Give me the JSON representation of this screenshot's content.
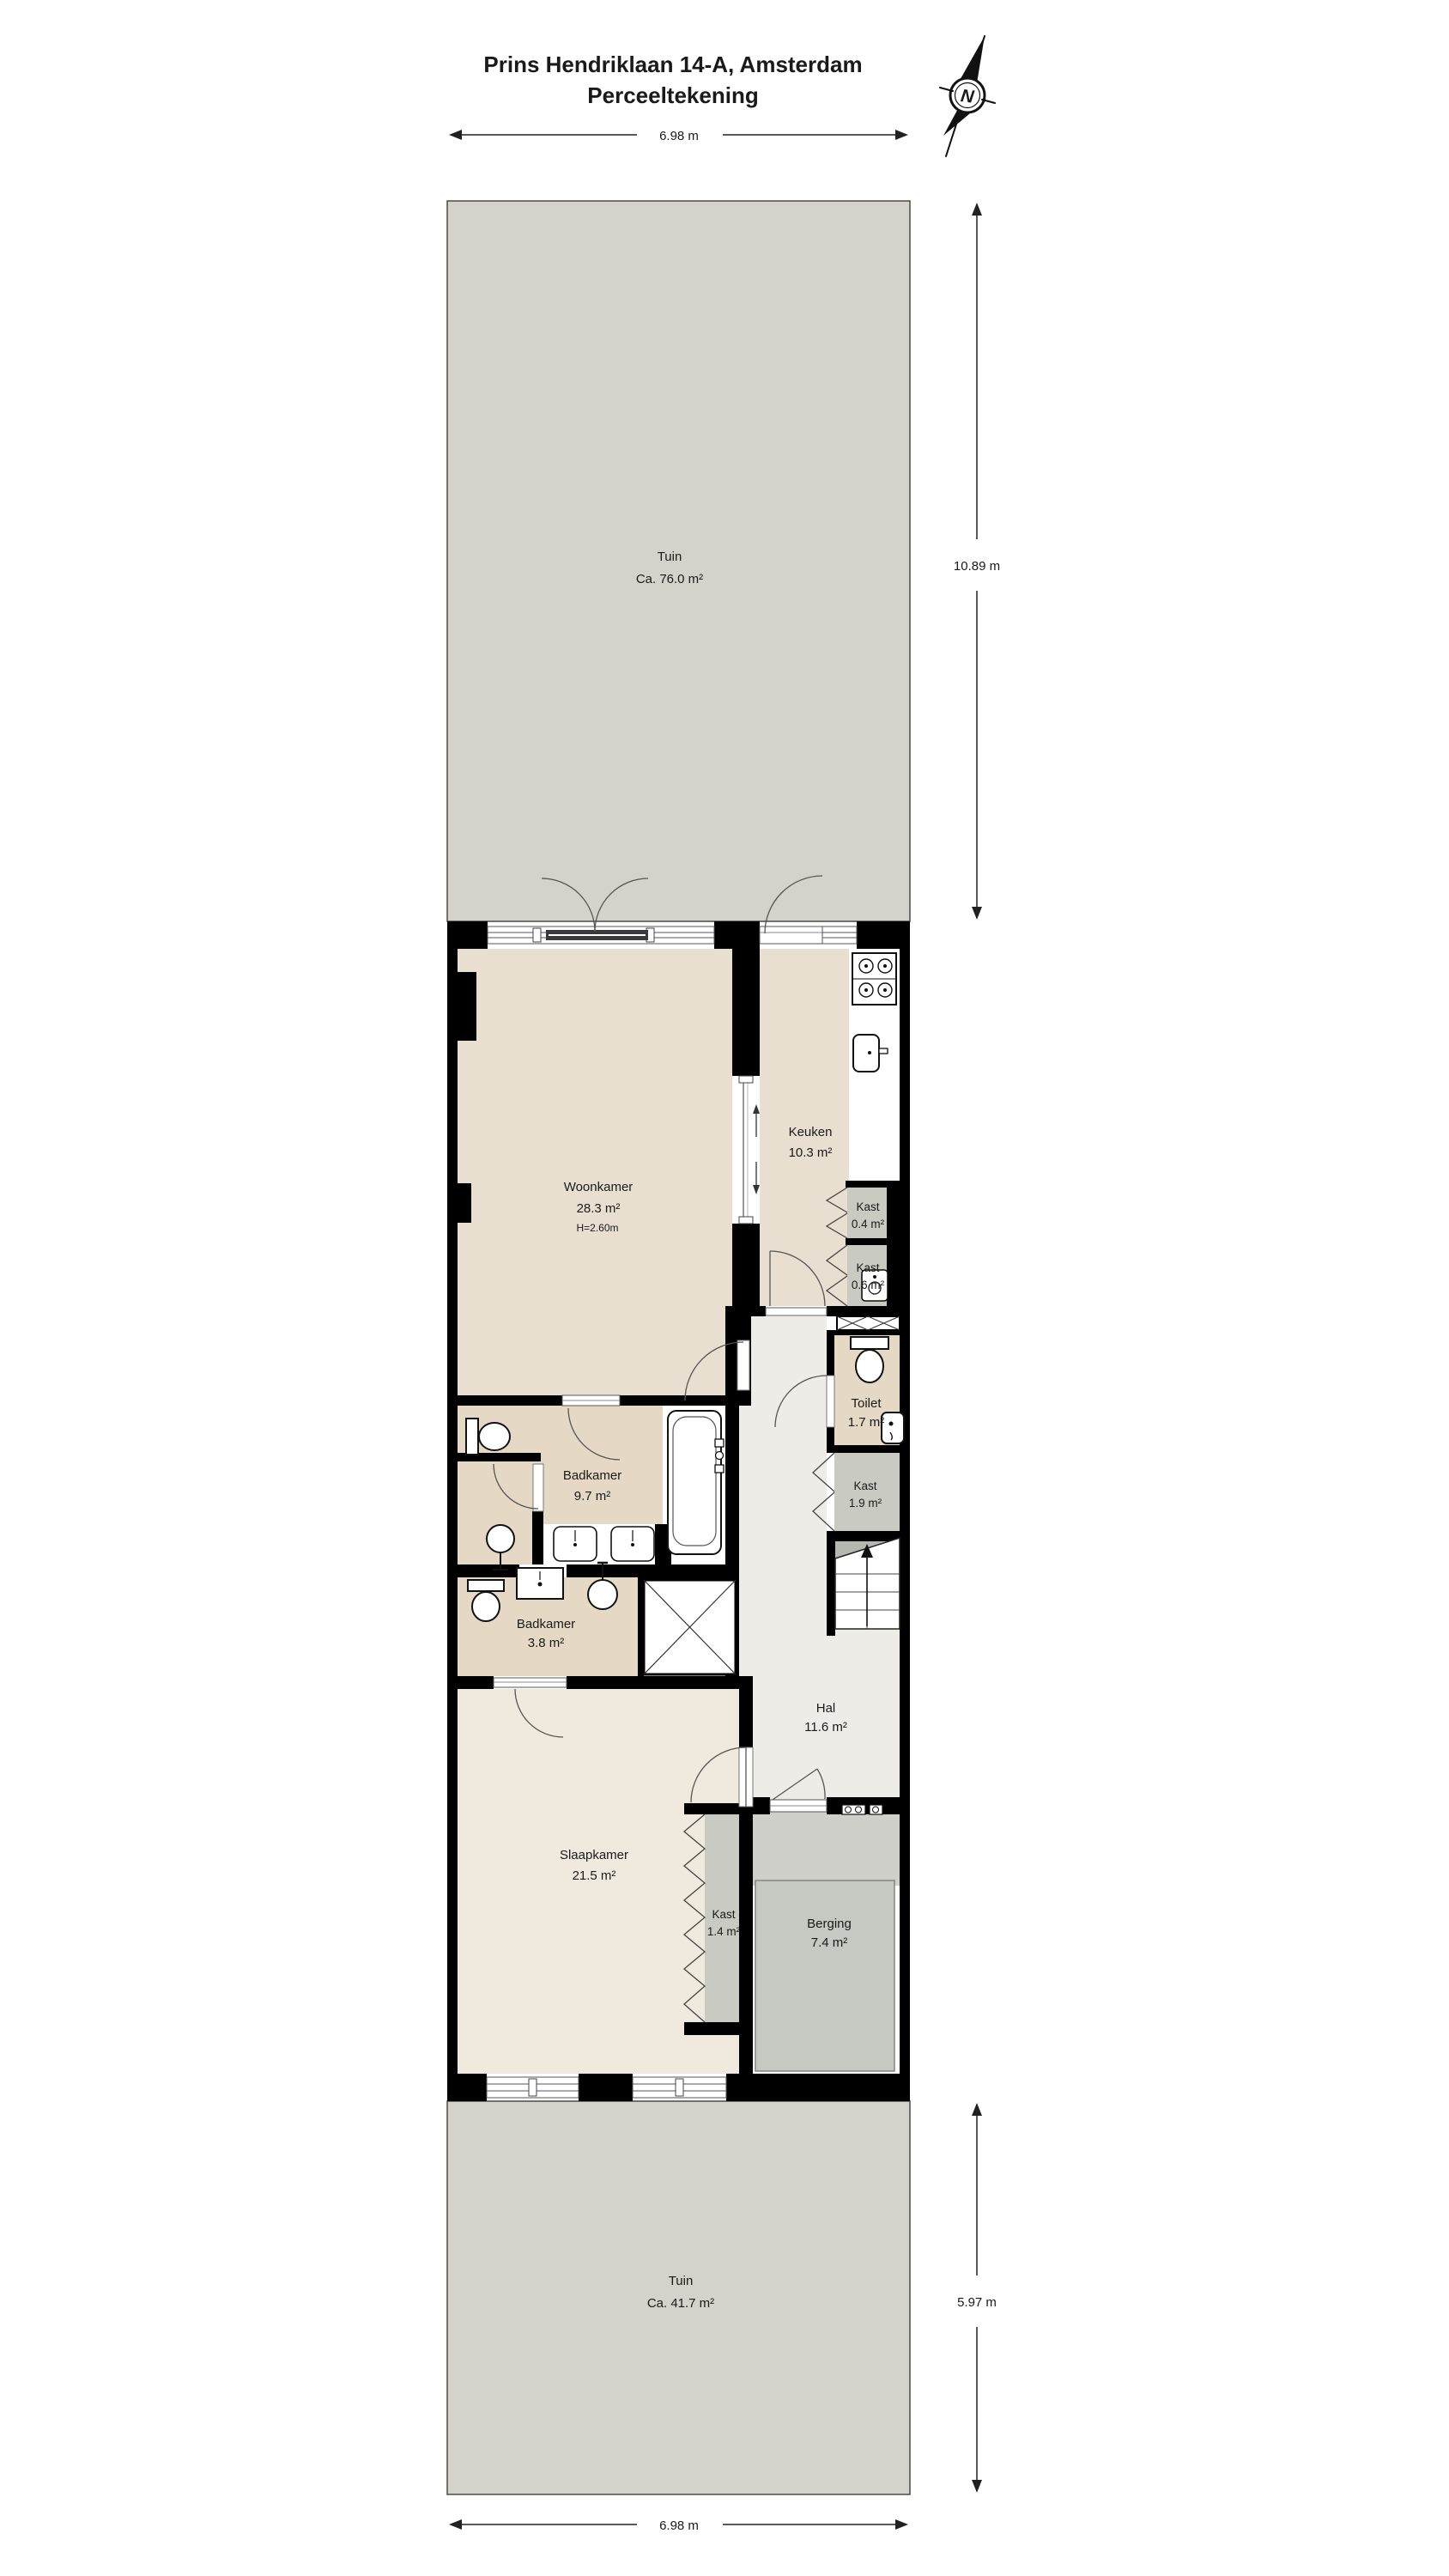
{
  "title": {
    "line1": "Prins Hendriklaan 14-A, Amsterdam",
    "line2": "Perceeltekening"
  },
  "compass": {
    "north_label": "N"
  },
  "dimensions": {
    "top_width": "6.98 m",
    "garden_top_depth": "10.89 m",
    "garden_bottom_depth": "5.97 m",
    "bottom_width": "6.98 m"
  },
  "gardens": {
    "top": {
      "name": "Tuin",
      "area": "Ca. 76.0 m²"
    },
    "bottom": {
      "name": "Tuin",
      "area": "Ca. 41.7 m²"
    }
  },
  "rooms": {
    "woonkamer": {
      "name": "Woonkamer",
      "area": "28.3 m²",
      "ceiling_height": "H=2.60m"
    },
    "keuken": {
      "name": "Keuken",
      "area": "10.3 m²"
    },
    "kast_04": {
      "name": "Kast",
      "area": "0.4 m²"
    },
    "kast_06": {
      "name": "Kast",
      "area": "0.6 m²"
    },
    "toilet": {
      "name": "Toilet",
      "area": "1.7 m²"
    },
    "kast_19": {
      "name": "Kast",
      "area": "1.9 m²"
    },
    "badkamer_97": {
      "name": "Badkamer",
      "area": "9.7 m²"
    },
    "badkamer_38": {
      "name": "Badkamer",
      "area": "3.8 m²"
    },
    "hal": {
      "name": "Hal",
      "area": "11.6 m²"
    },
    "slaapkamer": {
      "name": "Slaapkamer",
      "area": "21.5 m²"
    },
    "kast_14": {
      "name": "Kast",
      "area": "1.4 m²"
    },
    "berging": {
      "name": "Berging",
      "area": "7.4 m²"
    }
  },
  "colors": {
    "garden": "#d4d2ca",
    "wall": "#000000",
    "floor_living": "#e9dfd1",
    "floor_bath": "#e5d9c5",
    "floor_hall": "#edece6",
    "floor_bedroom": "#efeadd",
    "closet_gray": "#c9cbc3",
    "berging_gray": "#c6c9c2",
    "stair_gray": "#b5b8b0"
  }
}
